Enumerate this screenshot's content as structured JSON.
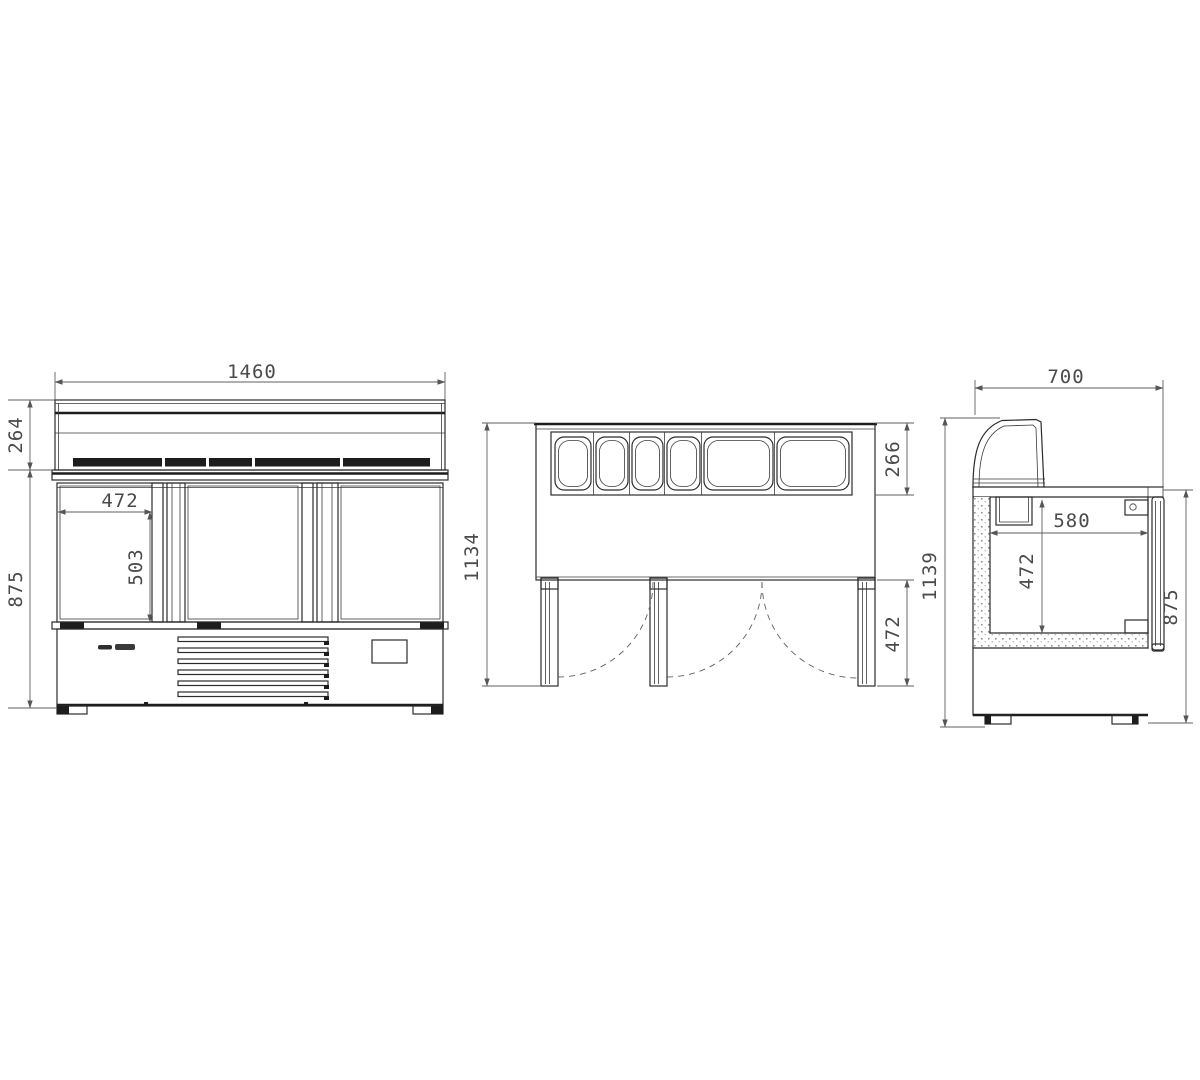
{
  "page": {
    "background": "#ffffff"
  },
  "drawing": {
    "type": "technical-3-view-counter",
    "line_color": "#2b2b2b",
    "dim_color": "#5f5f5f",
    "views": {
      "front": {
        "dims": {
          "width": "1460",
          "top_section_height": "264",
          "body_height": "875",
          "door_width": "472",
          "door_height": "503"
        }
      },
      "plan": {
        "dims": {
          "depth": "1134",
          "pan_well_depth": "266",
          "door_swing_depth": "472"
        }
      },
      "side": {
        "dims": {
          "width": "700",
          "total_height": "1139",
          "interior_width": "580",
          "interior_height": "472",
          "body_height": "875"
        }
      }
    }
  }
}
